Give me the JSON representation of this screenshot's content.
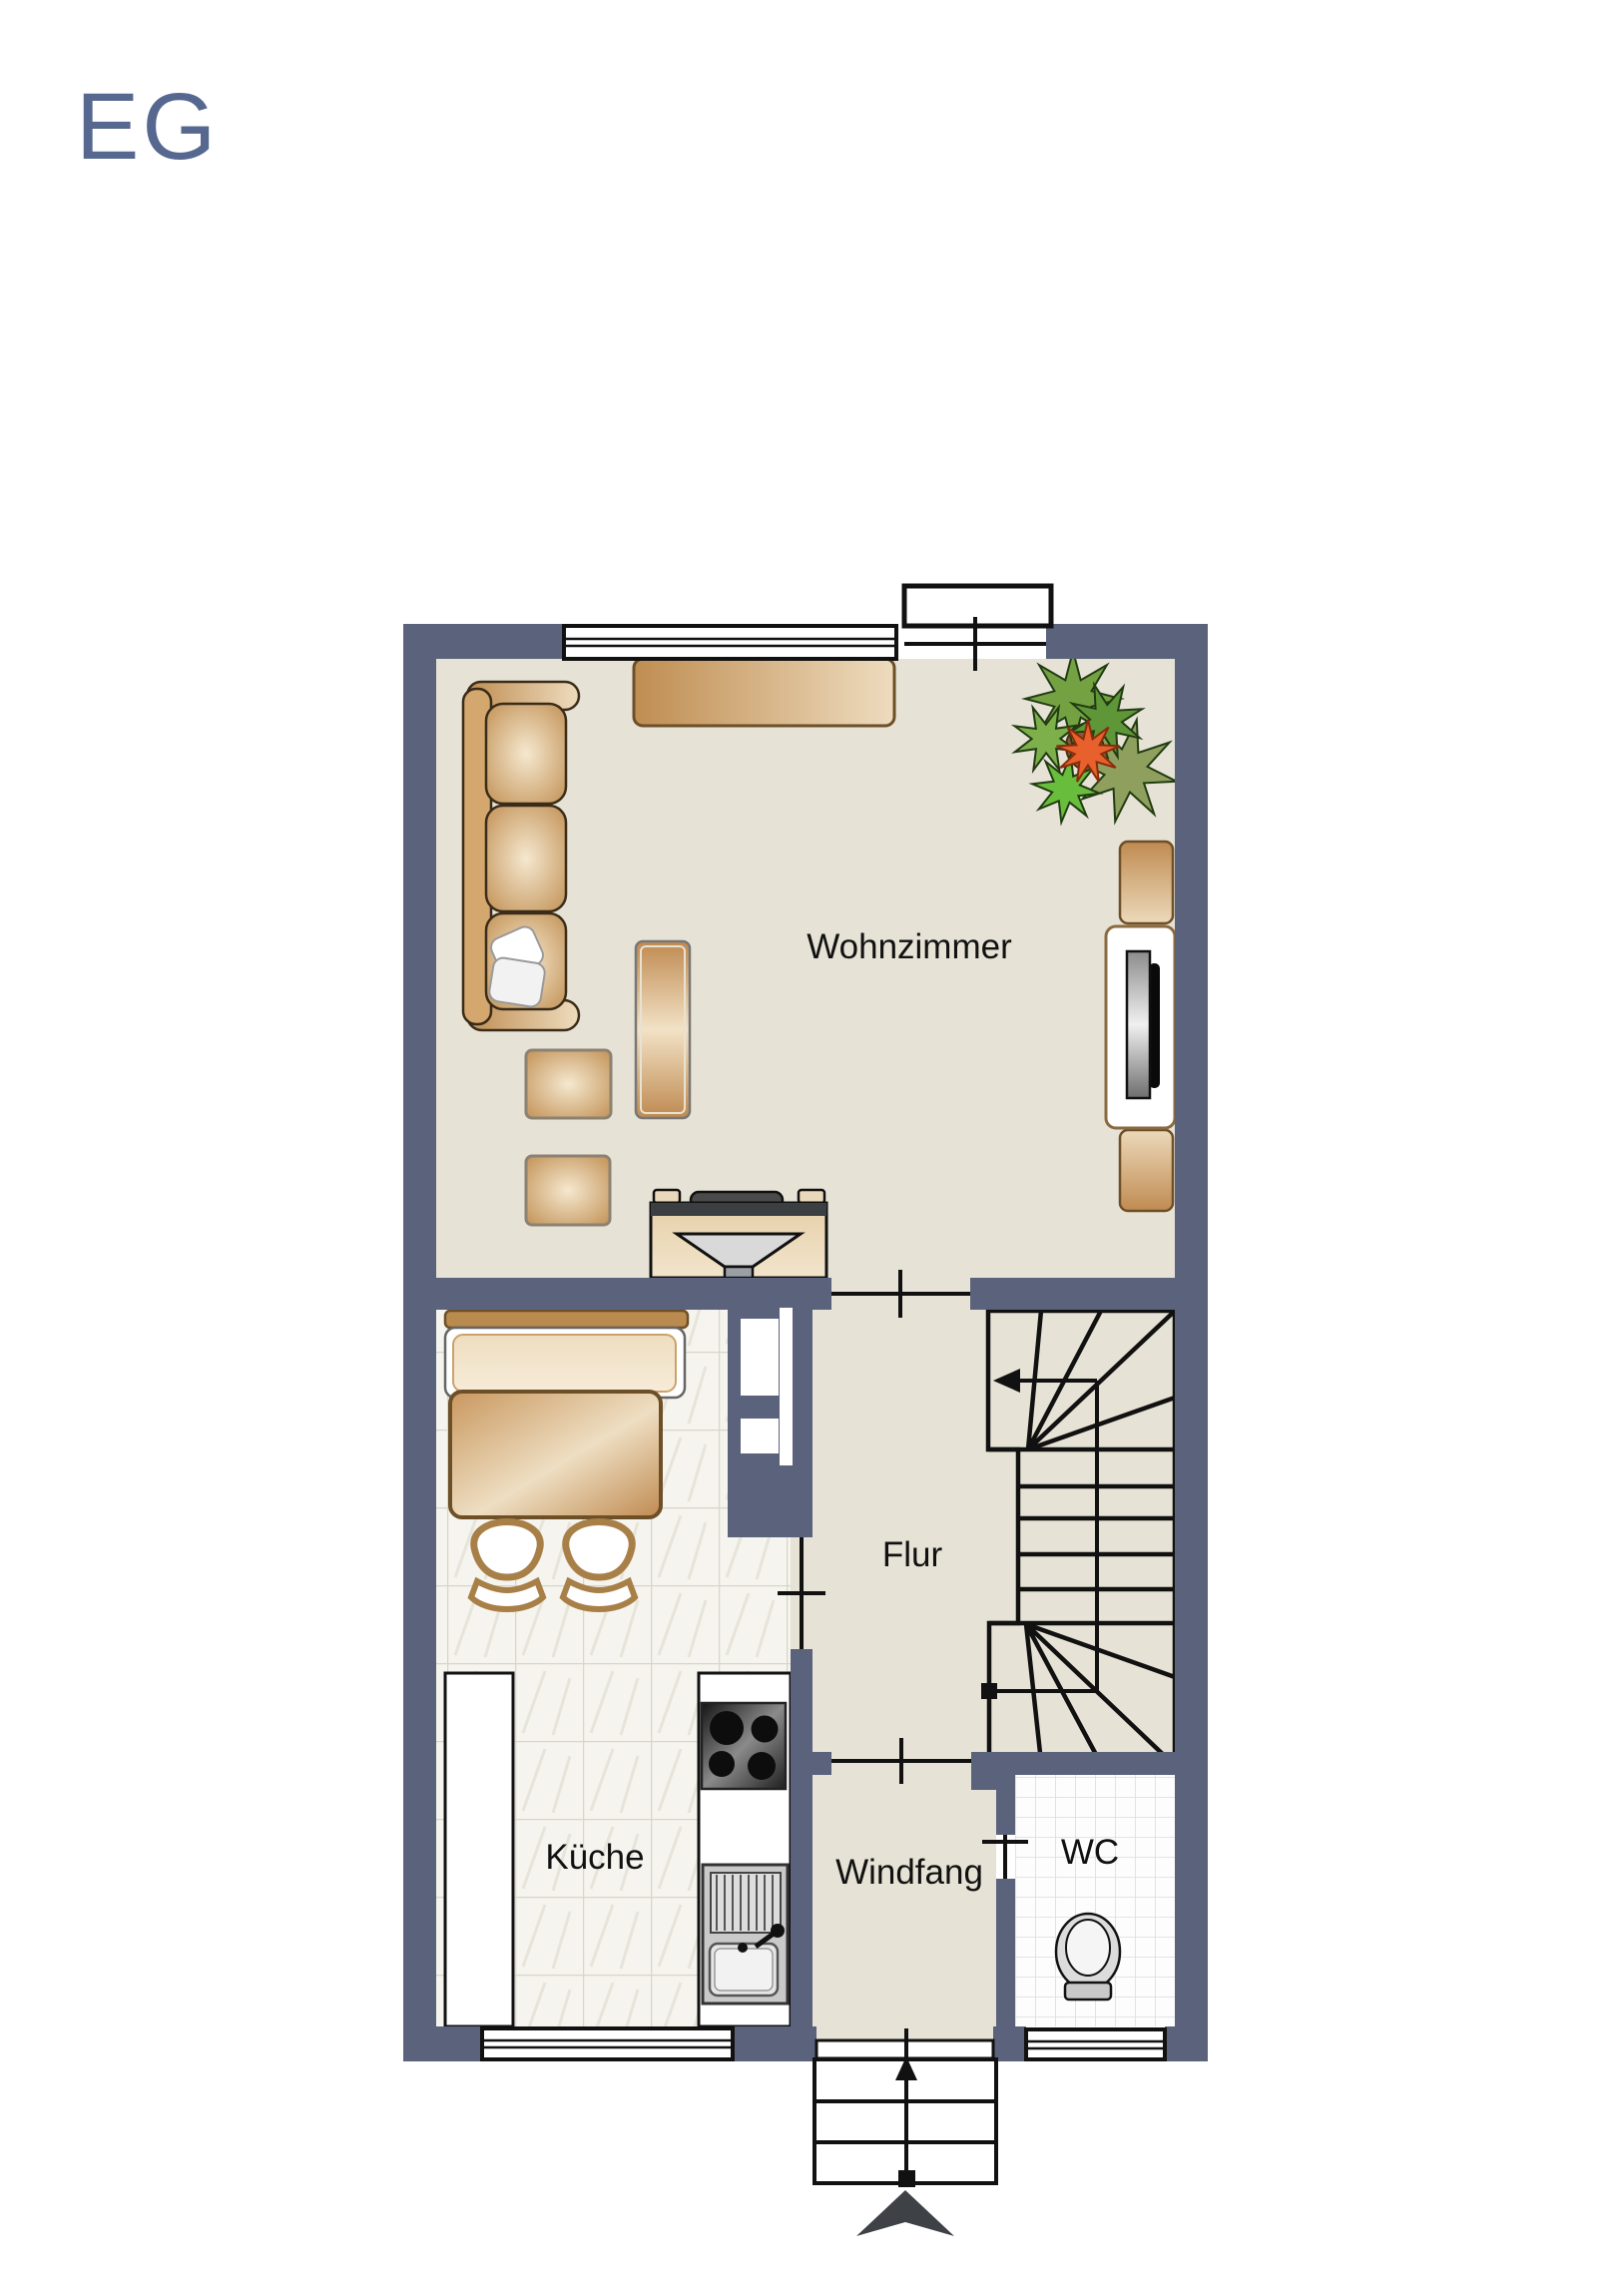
{
  "title": "EG",
  "rooms": {
    "wohnzimmer": {
      "label": "Wohnzimmer"
    },
    "flur": {
      "label": "Flur"
    },
    "kueche": {
      "label": "Küche"
    },
    "windfang": {
      "label": "Windfang"
    },
    "wc": {
      "label": "WC"
    }
  },
  "colors": {
    "title": "#56688f",
    "wall": "#5b627c",
    "floor": "#e6e2d5",
    "label": "#111111",
    "outline": "#111111",
    "tan_dark": "#bf8c52",
    "tan_light": "#f3e6cd",
    "brown_border": "#6d4f28",
    "plant_green": "#74a243",
    "plant_orange": "#e8612c"
  }
}
